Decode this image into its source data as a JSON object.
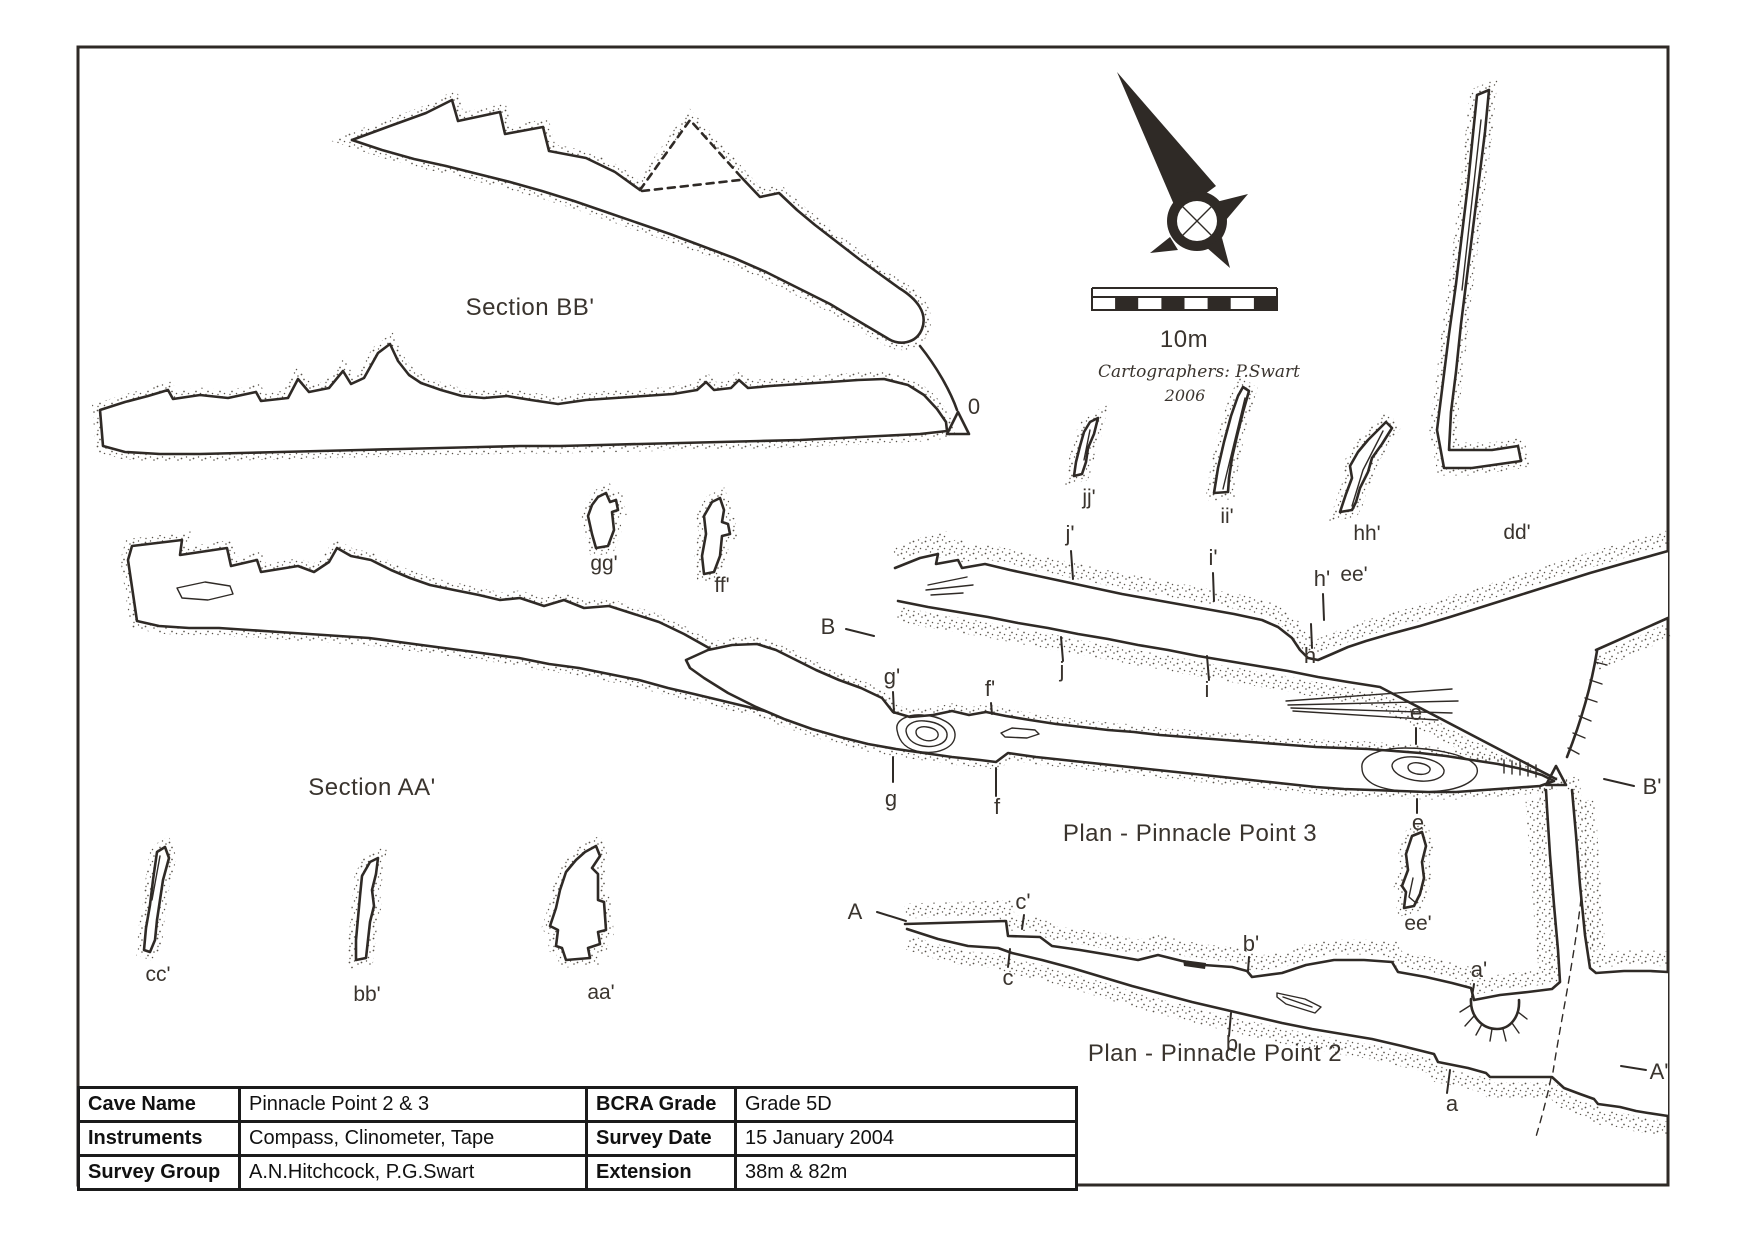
{
  "colors": {
    "ink": "#2f2a26",
    "paper": "#ffffff",
    "stipple_dot": "#59534b"
  },
  "labels": {
    "section_bb": "Section BB'",
    "section_aa": "Section AA'",
    "plan3": "Plan - Pinnacle Point 3",
    "plan2": "Plan - Pinnacle Point 2",
    "scale": "10m",
    "cartographers": "Cartographers: P.Swart",
    "year": "2006",
    "datum": "0"
  },
  "stations": {
    "B": "B",
    "Bp": "B'",
    "A": "A",
    "Ap": "A'",
    "jp": "j'",
    "ip": "i'",
    "hp": "h'",
    "j": "j",
    "i": "i",
    "h": "h",
    "gp": "g'",
    "fp": "f'",
    "g": "g",
    "f": "f",
    "eU": "e",
    "eL": "e",
    "cp": "c'",
    "c": "c",
    "bp": "b'",
    "b": "b",
    "ap": "a'",
    "a": "a"
  },
  "cross_sections": {
    "gg": "gg'",
    "ff": "ff'",
    "cc": "cc'",
    "bb": "bb'",
    "aa": "aa'",
    "jj": "jj'",
    "ii": "ii'",
    "hh": "hh'",
    "dd": "dd'",
    "ee_top": "ee'",
    "ee_bottom": "ee'"
  },
  "title_block": {
    "rows": [
      {
        "c0": "Cave Name",
        "c1": "Pinnacle Point 2 & 3",
        "c2": "BCRA Grade",
        "c3": "Grade 5D"
      },
      {
        "c0": "Instruments",
        "c1": "Compass, Clinometer, Tape",
        "c2": "Survey Date",
        "c3": "15 January 2004"
      },
      {
        "c0": "Survey Group",
        "c1": "A.N.Hitchcock, P.G.Swart",
        "c2": "Extension",
        "c3": "38m & 82m"
      }
    ]
  }
}
